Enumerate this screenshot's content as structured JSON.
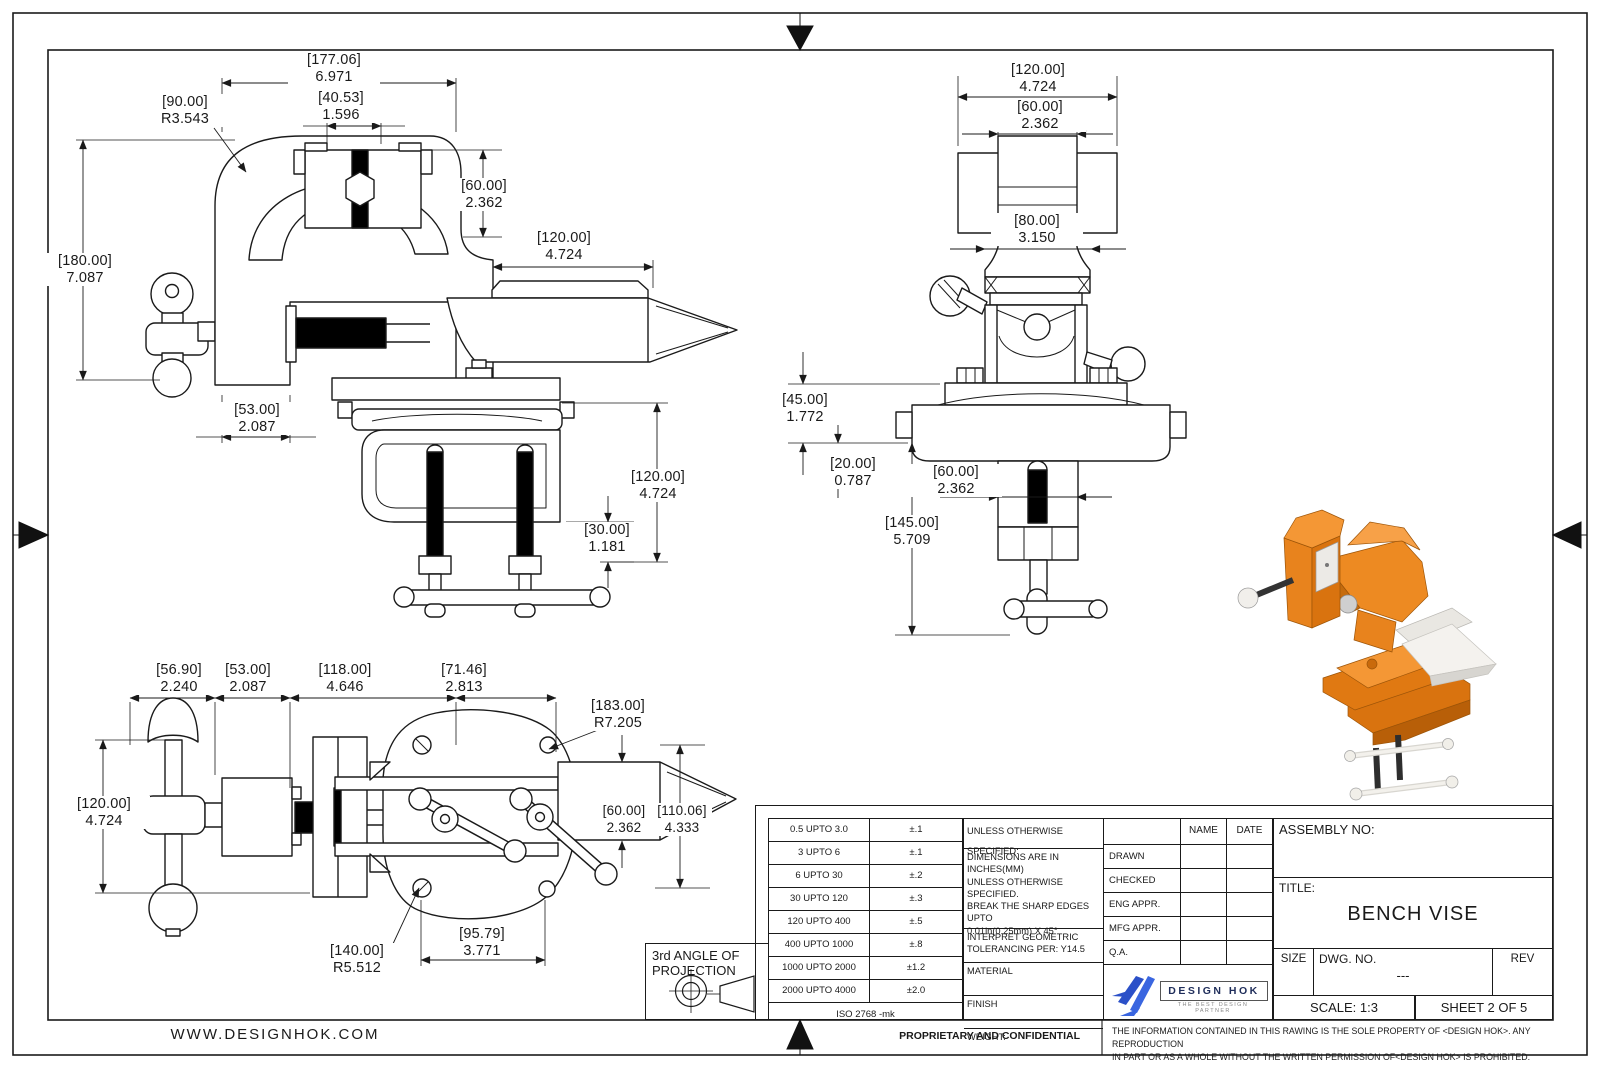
{
  "sheet": {
    "website": "WWW.DESIGNHOK.COM",
    "proprietary": "PROPRIETARY AND CONFIDENTIAL",
    "disclaimer1": "THE INFORMATION CONTAINED IN THIS RAWING IS THE SOLE PROPERTY OF <DESIGN HOK>.  ANY REPRODUCTION",
    "disclaimer2": "IN PART OR AS A WHOLE WITHOUT THE WRITTEN PERMISSION OF<DESIGN HOK> IS PROHIBITED."
  },
  "projection": {
    "line1": "3rd ANGLE OF",
    "line2": "PROJECTION"
  },
  "tolerances": {
    "rows": [
      {
        "range": "0.5 UPTO 3.0",
        "tol": "±.1"
      },
      {
        "range": "3 UPTO 6",
        "tol": "±.1"
      },
      {
        "range": "6 UPTO 30",
        "tol": "±.2"
      },
      {
        "range": "30 UPTO 120",
        "tol": "±.3"
      },
      {
        "range": "120 UPTO 400",
        "tol": "±.5"
      },
      {
        "range": "400 UPTO 1000",
        "tol": "±.8"
      },
      {
        "range": "1000 UPTO 2000",
        "tol": "±1.2"
      },
      {
        "range": "2000 UPTO 4000",
        "tol": "±2.0"
      }
    ],
    "standard": "ISO 2768 -mk"
  },
  "notes": {
    "header": "UNLESS OTHERWISE SPECIFIED:",
    "line1": "DIMENSIONS ARE IN INCHES(MM)",
    "line2": "UNLESS OTHERWISE",
    "line3": "SPECIFIED.",
    "line4": "BREAK THE SHARP EDGES UPTO",
    "line5": "0.01in(0.25mm) X 45°",
    "geo1": "INTERPRET GEOMETRIC",
    "geo2": "TOLERANCING PER: Y14.5",
    "material": "MATERIAL",
    "finish": "FINISH",
    "weight": "WEIGHT:"
  },
  "approvals": {
    "name": "NAME",
    "date": "DATE",
    "rows": [
      "DRAWN",
      "CHECKED",
      "ENG APPR.",
      "MFG APPR.",
      "Q.A."
    ]
  },
  "titleblock": {
    "assembly": "ASSEMBLY NO:",
    "title_label": "TITLE:",
    "title": "BENCH VISE",
    "size": "SIZE",
    "dwg": "DWG.  NO.",
    "dwg_value": "---",
    "rev": "REV",
    "scale": "SCALE: 1:3",
    "sheet": "SHEET 2 OF 5"
  },
  "logo": {
    "name": "DESIGN HOK",
    "tagline": "THE BEST DESIGN PARTNER"
  },
  "colors": {
    "vise_orange": "#E8831D",
    "logo_blue": "#2B50C8",
    "line": "#1A1A1A"
  },
  "dims": {
    "side": [
      {
        "mm": "[177.06]",
        "in": "6.971"
      },
      {
        "mm": "[90.00]",
        "in": "R3.543"
      },
      {
        "mm": "[40.53]",
        "in": "1.596"
      },
      {
        "mm": "[60.00]",
        "in": "2.362"
      },
      {
        "mm": "[120.00]",
        "in": "4.724"
      },
      {
        "mm": "[180.00]",
        "in": "7.087"
      },
      {
        "mm": "[53.00]",
        "in": "2.087"
      },
      {
        "mm": "[120.00]",
        "in": "4.724"
      },
      {
        "mm": "[30.00]",
        "in": "1.181"
      }
    ],
    "front": [
      {
        "mm": "[120.00]",
        "in": "4.724"
      },
      {
        "mm": "[60.00]",
        "in": "2.362"
      },
      {
        "mm": "[80.00]",
        "in": "3.150"
      },
      {
        "mm": "[45.00]",
        "in": "1.772"
      },
      {
        "mm": "[20.00]",
        "in": "0.787"
      },
      {
        "mm": "[60.00]",
        "in": "2.362"
      },
      {
        "mm": "[145.00]",
        "in": "5.709"
      }
    ],
    "top": [
      {
        "mm": "[56.90]",
        "in": "2.240"
      },
      {
        "mm": "[53.00]",
        "in": "2.087"
      },
      {
        "mm": "[118.00]",
        "in": "4.646"
      },
      {
        "mm": "[71.46]",
        "in": "2.813"
      },
      {
        "mm": "[183.00]",
        "in": "R7.205"
      },
      {
        "mm": "[120.00]",
        "in": "4.724"
      },
      {
        "mm": "[60.00]",
        "in": "2.362"
      },
      {
        "mm": "[110.06]",
        "in": "4.333"
      },
      {
        "mm": "[95.79]",
        "in": "3.771"
      },
      {
        "mm": "[140.00]",
        "in": "R5.512"
      }
    ]
  }
}
